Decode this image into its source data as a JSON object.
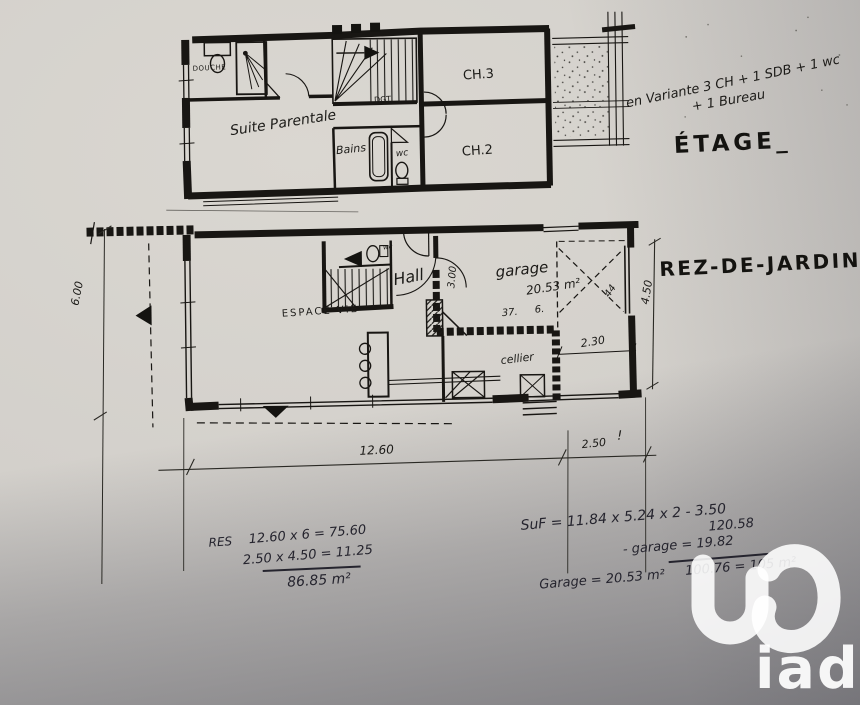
{
  "etage": {
    "title": "ÉTAGE_",
    "note_line1": "en Variante 3 CH + 1 SDB + 1 wc",
    "note_line2": "+ 1 Bureau",
    "rooms": {
      "douche": "DOUCHE",
      "suite_parentale": "Suite Parentale",
      "degagement": "DGT",
      "bains": "Bains",
      "wc": "wc",
      "ch3": "CH.3",
      "ch2": "CH.2"
    }
  },
  "rez_de_jardin": {
    "title": "REZ-DE-JARDIN_",
    "rooms": {
      "espace_vie": "ESPACE VIE",
      "hall": "Hall",
      "wc": "wc",
      "garage": "garage",
      "garage_area": "20.53 m²",
      "cellier": "cellier"
    },
    "annotations": {
      "garage_depth": "3.00",
      "n37": "37.",
      "n6": "6.",
      "door_width": "2.30",
      "diag": "44"
    }
  },
  "dimensions": {
    "bottom_main": "12.60",
    "bottom_right": "2.50",
    "left_vertical": "6.00",
    "right_vertical": "4.50",
    "exclaim": "!"
  },
  "calculations": {
    "left": {
      "label": "RES",
      "line1": "12.60 x 6 = 75.60",
      "line2": "2.50 x 4.50 = 11.25",
      "total": "86.85 m²"
    },
    "right": {
      "line1": "SuF = 11.84 x 5.24 x 2 - 3.50",
      "line1_result": "120.58",
      "line2": "- garage = 19.82",
      "line3": "100.76 = 105 m²",
      "garage_line": "Garage = 20.53 m²"
    }
  },
  "watermark": {
    "brand": "iad"
  }
}
